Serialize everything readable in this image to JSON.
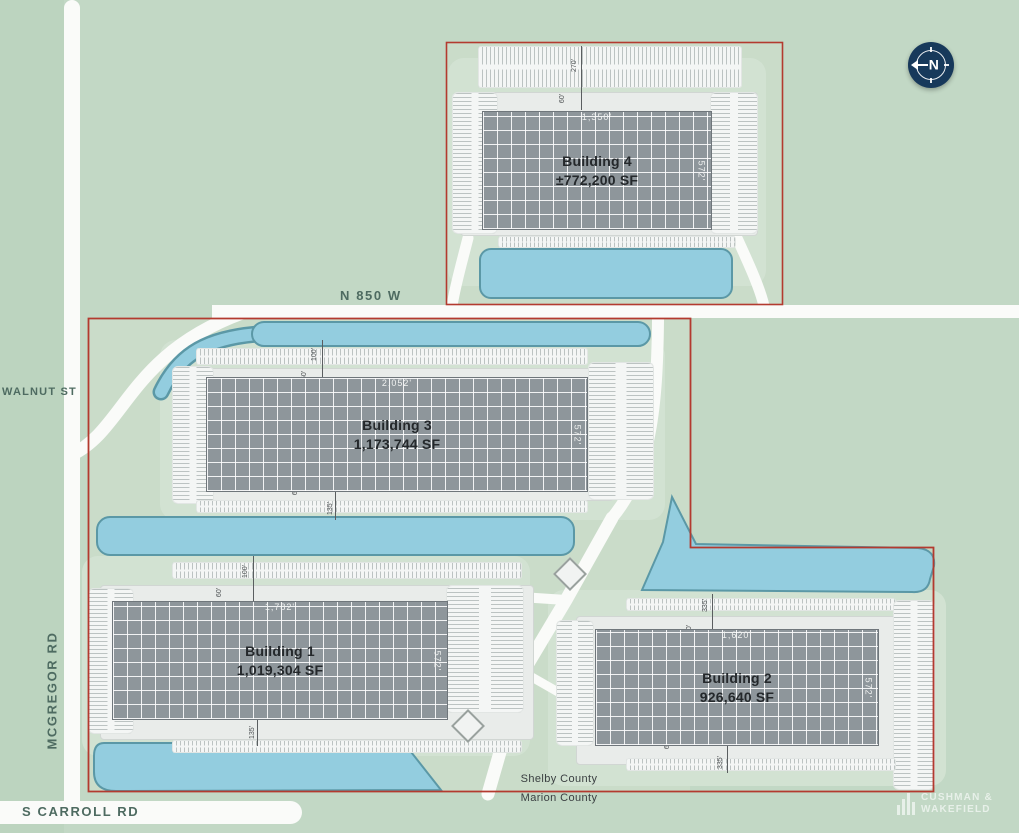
{
  "site": {
    "title": "Industrial park site plan",
    "roads": {
      "north_road": "N 850 W",
      "west_street": "WALNUT ST",
      "west_road": "MCGREGOR RD",
      "south_road": "S CARROLL RD"
    },
    "county_line": {
      "north": "Shelby County",
      "south": "Marion County"
    },
    "compass": {
      "label": "N"
    },
    "logo": {
      "line1": "CUSHMAN &",
      "line2": "WAKEFIELD"
    },
    "colors": {
      "background_green": "#c2d8c5",
      "water": "#93cddf",
      "water_edge": "#5b98a6",
      "building_roof": "#8e969b",
      "boundary_red": "#b33a2f",
      "road_label_teal": "#4e6b61",
      "compass_navy": "#17395b"
    }
  },
  "buildings": {
    "b1": {
      "name": "Building 1",
      "area": "1,019,304 SF",
      "length": "1,782'",
      "depth": "572'",
      "dims": {
        "north_outer": "100'",
        "north_inner": "60'",
        "south_inner": "60'",
        "south_outer": "135'"
      }
    },
    "b2": {
      "name": "Building 2",
      "area": "926,640 SF",
      "length": "1,620'",
      "depth": "572'",
      "dims": {
        "north_outer": "335'",
        "north_inner": "60'",
        "south_inner": "60'",
        "south_outer": "335'"
      }
    },
    "b3": {
      "name": "Building 3",
      "area": "1,173,744 SF",
      "length": "2,052'",
      "depth": "572'",
      "dims": {
        "north_outer": "100'",
        "north_inner": "60'",
        "south_inner": "60'",
        "south_outer": "135'"
      }
    },
    "b4": {
      "name": "Building 4",
      "area": "±772,200 SF",
      "length": "1,350'",
      "depth": "572'",
      "dims": {
        "north_outer": "270'",
        "north_inner": "60'"
      }
    }
  }
}
